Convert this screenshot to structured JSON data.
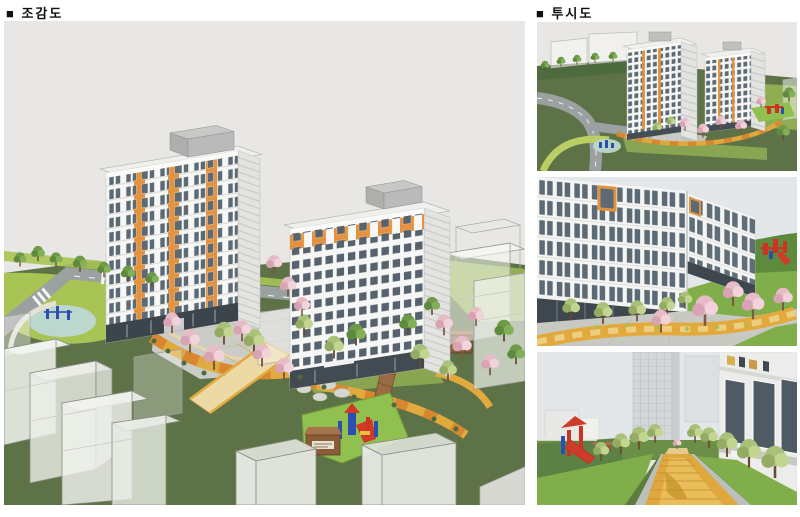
{
  "labels": {
    "aerial": "■ 조감도",
    "perspective": "■ 투시도"
  },
  "figures": [
    "aerial-site-render",
    "perspective-overview-render",
    "courtyard-closeup-render",
    "walkway-ground-render"
  ],
  "colors": {
    "page_bg": "#ffffff",
    "sky": "#e8e7e5",
    "sky_cool": "#e3e7ea",
    "grass_dark": "#5d7247",
    "grass_bright": "#7fae4a",
    "grass_light": "#a8c455",
    "building_white": "#f7f7f5",
    "building_shade": "#e3e3e1",
    "accent_orange": "#e59240",
    "window_glass": "#5b6a74",
    "storefront_dark": "#3f474e",
    "roof_gray": "#c0c0be",
    "road_gray": "#9ba0a1",
    "path_yellow": "#e2a93d",
    "path_orange": "#d8862f",
    "path_pale": "#ecd9a4",
    "wood_brown": "#96663f",
    "blossom_pink": "#e7bcc8",
    "tree_green": "#6f9a49",
    "play_red": "#cc3322",
    "play_blue": "#2a4fae",
    "ghost_line": "#8a8d85"
  }
}
